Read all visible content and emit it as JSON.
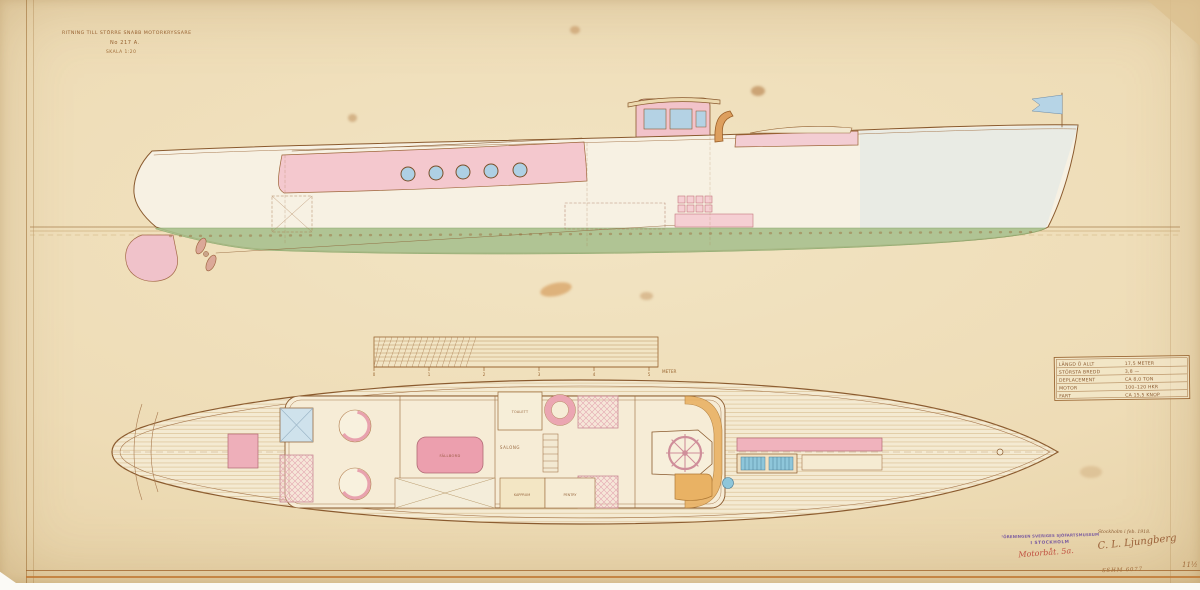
{
  "title_block": {
    "line1": "RITNING TILL STÖRRE SNABB MOTORKRYSSARE",
    "line2": "No 217 A.",
    "line3": "SKALA 1:20"
  },
  "spec_table": {
    "rows": [
      {
        "label": "LÄNGD Ö ALLT",
        "value": "17,5 METER"
      },
      {
        "label": "STÖRSTA BREDD",
        "value": "3,8 —"
      },
      {
        "label": "DEPLACEMENT",
        "value": "CA 8,0 TON"
      },
      {
        "label": "MOTOR",
        "value": "100–120 HKR"
      },
      {
        "label": "FART",
        "value": "CA 15,5 KNOP"
      }
    ]
  },
  "scale_bar": {
    "ticks": [
      "0",
      "1",
      "2",
      "3",
      "4",
      "5"
    ],
    "unit": "METER"
  },
  "plan": {
    "labels": {
      "fallbord": "FÄLLBORD",
      "salong": "SALONG",
      "toalett": "TOALETT",
      "kapprum": "KAPPRUM",
      "pentry": "PENTRY"
    }
  },
  "stamp": {
    "line1": "FÖRENINGEN SVERIGES SJÖFARTSMUSEUM",
    "line2": "I STOCKHOLM",
    "class_note": "Motorbåt. 5a."
  },
  "signature": {
    "place_date": "Stockholm i feb. 1918.",
    "name": "C. L. Ljungberg"
  },
  "archive": {
    "catalog_number": "SSHM 6077",
    "sheet_number": "11½"
  },
  "colors": {
    "paper": "#eedcb6",
    "ink": "#8a5a2e",
    "pink": "#f2c6cc",
    "underwater_green": "#a9c08c",
    "light_blue": "#aed0e4",
    "orange": "#e9b264",
    "stamp_purple": "#7b5ca0",
    "note_red": "#c05040"
  }
}
